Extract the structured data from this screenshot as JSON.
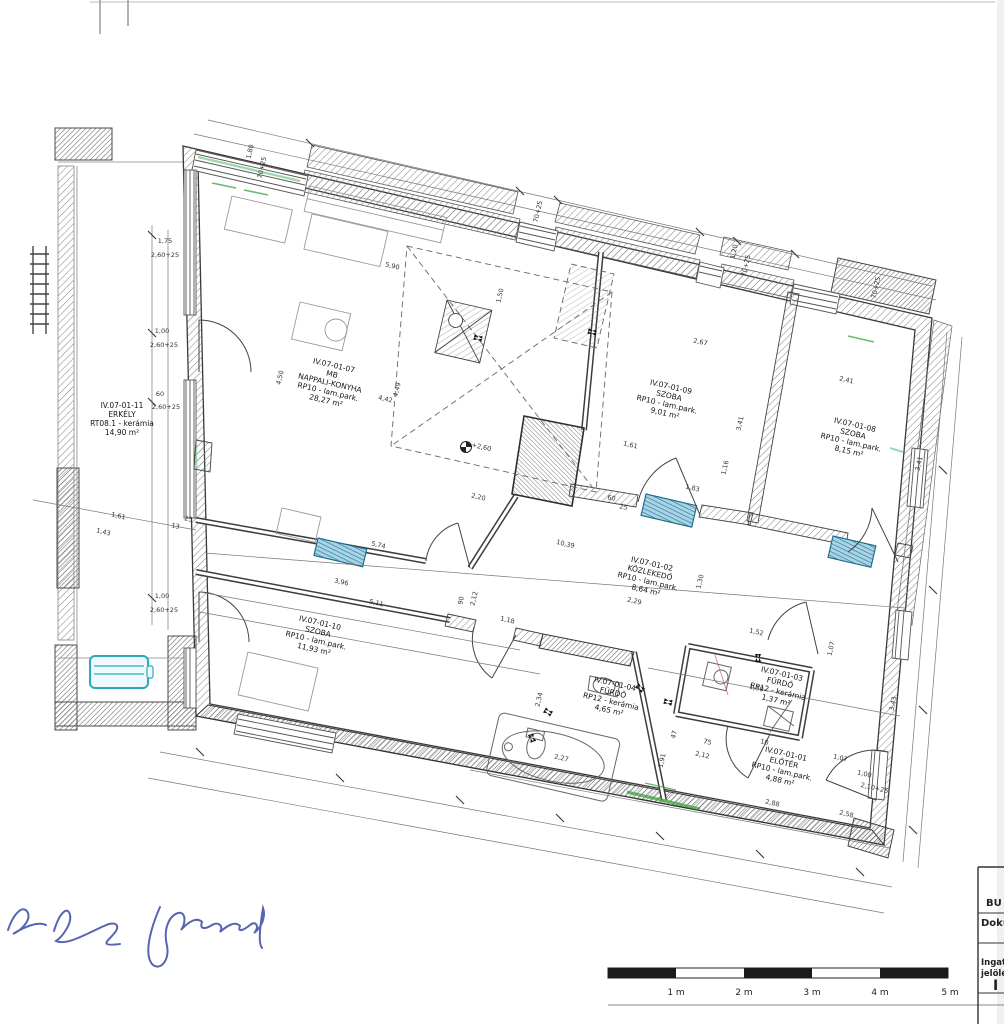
{
  "title_block": {
    "row1": "BU",
    "row2": "Doku",
    "row3_line1": "Ingat",
    "row3_line2": "jelölé",
    "row3_line3": "I"
  },
  "scale_bar": {
    "labels": [
      "1 m",
      "2 m",
      "3 m",
      "4 m",
      "5 m"
    ]
  },
  "colors": {
    "ink": "#3a3a3a",
    "hatch": "#8a8a8a",
    "radiator_blue": "#a8d4e6",
    "radiator_stripe": "#21708e",
    "bench_teal": "#2fa8bc",
    "green_mark": "#3aa33a",
    "signature_blue": "#4553a8"
  },
  "rooms": [
    {
      "id": "IV.07-01-07",
      "sub": "MB",
      "name": "NAPPALI-KONYHA",
      "floor": "RP10 - lam.park.",
      "area": "28,27 m²",
      "cx": 330,
      "cy": 383,
      "rot": 13
    },
    {
      "id": "IV.07-01-09",
      "sub": "",
      "name": "SZOBA",
      "floor": "RP10 - lam.park.",
      "area": "9,01 m²",
      "cx": 668,
      "cy": 400,
      "rot": 13
    },
    {
      "id": "IV.07-01-08",
      "sub": "",
      "name": "SZOBA",
      "floor": "RP10 - lam.park.",
      "area": "8,15 m²",
      "cx": 852,
      "cy": 438,
      "rot": 13
    },
    {
      "id": "IV.07-01-11",
      "sub": "",
      "name": "ERKÉLY",
      "floor": "RT08.1 - kerámia",
      "area": "14,90 m²",
      "cx": 122,
      "cy": 419,
      "rot": 0
    },
    {
      "id": "IV.07-01-02",
      "sub": "",
      "name": "KÖZLEKEDŐ",
      "floor": "RP10 - lam.park.",
      "area": "8,64 m²",
      "cx": 649,
      "cy": 577,
      "rot": 13
    },
    {
      "id": "IV.07-01-10",
      "sub": "",
      "name": "SZOBA",
      "floor": "RP10 - lam.park.",
      "area": "11,93 m²",
      "cx": 317,
      "cy": 636,
      "rot": 13
    },
    {
      "id": "IV.07-01-04",
      "sub": "",
      "name": "FÜRDŐ",
      "floor": "RP12 - kerámia",
      "area": "4,65 m²",
      "cx": 612,
      "cy": 697,
      "rot": 13
    },
    {
      "id": "IV.07-01-03",
      "sub": "",
      "name": "FÜRDŐ",
      "floor": "RP12 - kerámia",
      "area": "1,37 m²",
      "cx": 779,
      "cy": 687,
      "rot": 13
    },
    {
      "id": "IV.07-01-01",
      "sub": "",
      "name": "ELŐTÉR",
      "floor": "RP10 - lam.park.",
      "area": "4,88 m²",
      "cx": 783,
      "cy": 767,
      "rot": 13
    }
  ],
  "dimensions": [
    {
      "t": "1,80",
      "x": 252,
      "y": 152,
      "r": -77
    },
    {
      "t": "70+25",
      "x": 264,
      "y": 168,
      "r": -77
    },
    {
      "t": "70+25",
      "x": 540,
      "y": 212,
      "r": -77
    },
    {
      "t": "1,20",
      "x": 736,
      "y": 252,
      "r": -77
    },
    {
      "t": "70+25",
      "x": 748,
      "y": 266,
      "r": -77
    },
    {
      "t": "70+25",
      "x": 878,
      "y": 288,
      "r": -77
    },
    {
      "t": "1,75",
      "x": 165,
      "y": 243,
      "r": 0
    },
    {
      "t": "2,60+25",
      "x": 165,
      "y": 257,
      "r": 0
    },
    {
      "t": "1,00",
      "x": 162,
      "y": 333,
      "r": 0
    },
    {
      "t": "2,60+25",
      "x": 164,
      "y": 347,
      "r": 0
    },
    {
      "t": "60",
      "x": 160,
      "y": 396,
      "r": 0
    },
    {
      "t": "2,60+25",
      "x": 166,
      "y": 409,
      "r": 0
    },
    {
      "t": "1,00",
      "x": 162,
      "y": 598,
      "r": 0
    },
    {
      "t": "2,60+25",
      "x": 164,
      "y": 612,
      "r": 0
    },
    {
      "t": "5,90",
      "x": 392,
      "y": 268,
      "r": 13
    },
    {
      "t": "1,50",
      "x": 502,
      "y": 296,
      "r": -77
    },
    {
      "t": "4,50",
      "x": 282,
      "y": 378,
      "r": -77
    },
    {
      "t": "4,42",
      "x": 385,
      "y": 401,
      "r": 13
    },
    {
      "t": "4,49",
      "x": 399,
      "y": 390,
      "r": -77
    },
    {
      "t": "2,67",
      "x": 700,
      "y": 344,
      "r": 13
    },
    {
      "t": "2,41",
      "x": 846,
      "y": 382,
      "r": 13
    },
    {
      "t": "3,41",
      "x": 742,
      "y": 424,
      "r": -77
    },
    {
      "t": "3,41",
      "x": 921,
      "y": 464,
      "r": -77
    },
    {
      "t": "1,61",
      "x": 630,
      "y": 447,
      "r": 13
    },
    {
      "t": "1,16",
      "x": 727,
      "y": 468,
      "r": -77
    },
    {
      "t": "1,83",
      "x": 692,
      "y": 490,
      "r": 13
    },
    {
      "t": "+2,60",
      "x": 481,
      "y": 449,
      "r": 13
    },
    {
      "t": "2,20",
      "x": 478,
      "y": 499,
      "r": 13
    },
    {
      "t": "1,61",
      "x": 118,
      "y": 518,
      "r": 13
    },
    {
      "t": "1,43",
      "x": 103,
      "y": 534,
      "r": 13
    },
    {
      "t": "25",
      "x": 188,
      "y": 521,
      "r": 13
    },
    {
      "t": "13",
      "x": 175,
      "y": 528,
      "r": 13
    },
    {
      "t": "5,74",
      "x": 378,
      "y": 547,
      "r": 13
    },
    {
      "t": "10,39",
      "x": 565,
      "y": 546,
      "r": 13
    },
    {
      "t": "2,29",
      "x": 634,
      "y": 603,
      "r": 13
    },
    {
      "t": "1,30",
      "x": 702,
      "y": 582,
      "r": -77
    },
    {
      "t": "3,96",
      "x": 341,
      "y": 584,
      "r": 13
    },
    {
      "t": "5,11",
      "x": 376,
      "y": 605,
      "r": 13
    },
    {
      "t": "90",
      "x": 463,
      "y": 601,
      "r": -77
    },
    {
      "t": "2,12",
      "x": 476,
      "y": 599,
      "r": -77
    },
    {
      "t": "1,18",
      "x": 507,
      "y": 622,
      "r": 13
    },
    {
      "t": "60",
      "x": 611,
      "y": 500,
      "r": 13
    },
    {
      "t": "25",
      "x": 623,
      "y": 509,
      "r": 13
    },
    {
      "t": "1,52",
      "x": 756,
      "y": 634,
      "r": 13
    },
    {
      "t": "1,07",
      "x": 833,
      "y": 649,
      "r": -77
    },
    {
      "t": "2,34",
      "x": 541,
      "y": 700,
      "r": -77
    },
    {
      "t": "2,27",
      "x": 561,
      "y": 760,
      "r": 13
    },
    {
      "t": "1,91",
      "x": 664,
      "y": 761,
      "r": -77
    },
    {
      "t": "47",
      "x": 676,
      "y": 735,
      "r": -77
    },
    {
      "t": "75",
      "x": 707,
      "y": 744,
      "r": 13
    },
    {
      "t": "2,12",
      "x": 702,
      "y": 757,
      "r": 13
    },
    {
      "t": "10",
      "x": 764,
      "y": 744,
      "r": 13
    },
    {
      "t": "1,30",
      "x": 756,
      "y": 690,
      "r": 13
    },
    {
      "t": "1,07",
      "x": 840,
      "y": 760,
      "r": 13
    },
    {
      "t": "2,88",
      "x": 772,
      "y": 805,
      "r": 13
    },
    {
      "t": "1,00",
      "x": 864,
      "y": 776,
      "r": 13
    },
    {
      "t": "2,10+25",
      "x": 874,
      "y": 790,
      "r": 13
    },
    {
      "t": "2,58",
      "x": 846,
      "y": 816,
      "r": 13
    },
    {
      "t": "3,43",
      "x": 895,
      "y": 704,
      "r": -77
    }
  ]
}
